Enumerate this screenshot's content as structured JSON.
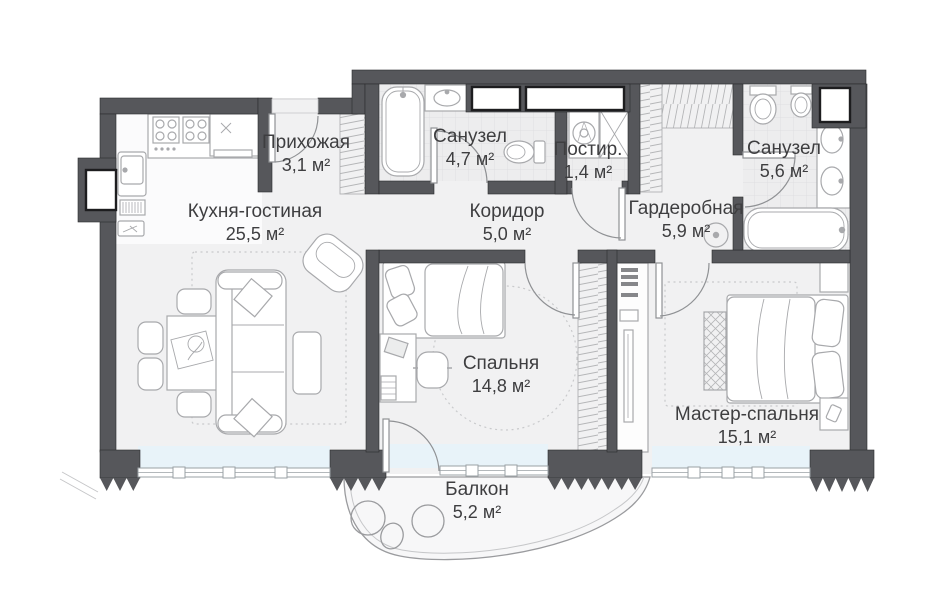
{
  "plan": {
    "title": "apartment-floor-plan",
    "language": "ru",
    "rooms": [
      {
        "id": "hallway",
        "name": "Прихожая",
        "area": "3,1 м²"
      },
      {
        "id": "kitchen-living",
        "name": "Кухня-гостиная",
        "area": "25,5 м²"
      },
      {
        "id": "bathroom-1",
        "name": "Санузел",
        "area": "4,7 м²"
      },
      {
        "id": "corridor",
        "name": "Коридор",
        "area": "5,0 м²"
      },
      {
        "id": "laundry",
        "name": "Постир.",
        "area": "1,4 м²"
      },
      {
        "id": "wardrobe",
        "name": "Гардеробная",
        "area": "5,9 м²"
      },
      {
        "id": "bathroom-2",
        "name": "Санузел",
        "area": "5,6 м²"
      },
      {
        "id": "bedroom",
        "name": "Спальня",
        "area": "14,8 м²"
      },
      {
        "id": "master-bedroom",
        "name": "Мастер-спальня",
        "area": "15,1 м²"
      },
      {
        "id": "balcony",
        "name": "Балкон",
        "area": "5,2 м²"
      }
    ],
    "colors": {
      "wall": "#56575b",
      "floor": "#f1f1f2",
      "kitchen_floor": "#fbfbfc",
      "tile": "#ededee",
      "glass": "#e8f3f9",
      "furniture_line": "#a8a9ac",
      "hatch": "#b5b6b8",
      "text": "#3e3e40"
    }
  }
}
